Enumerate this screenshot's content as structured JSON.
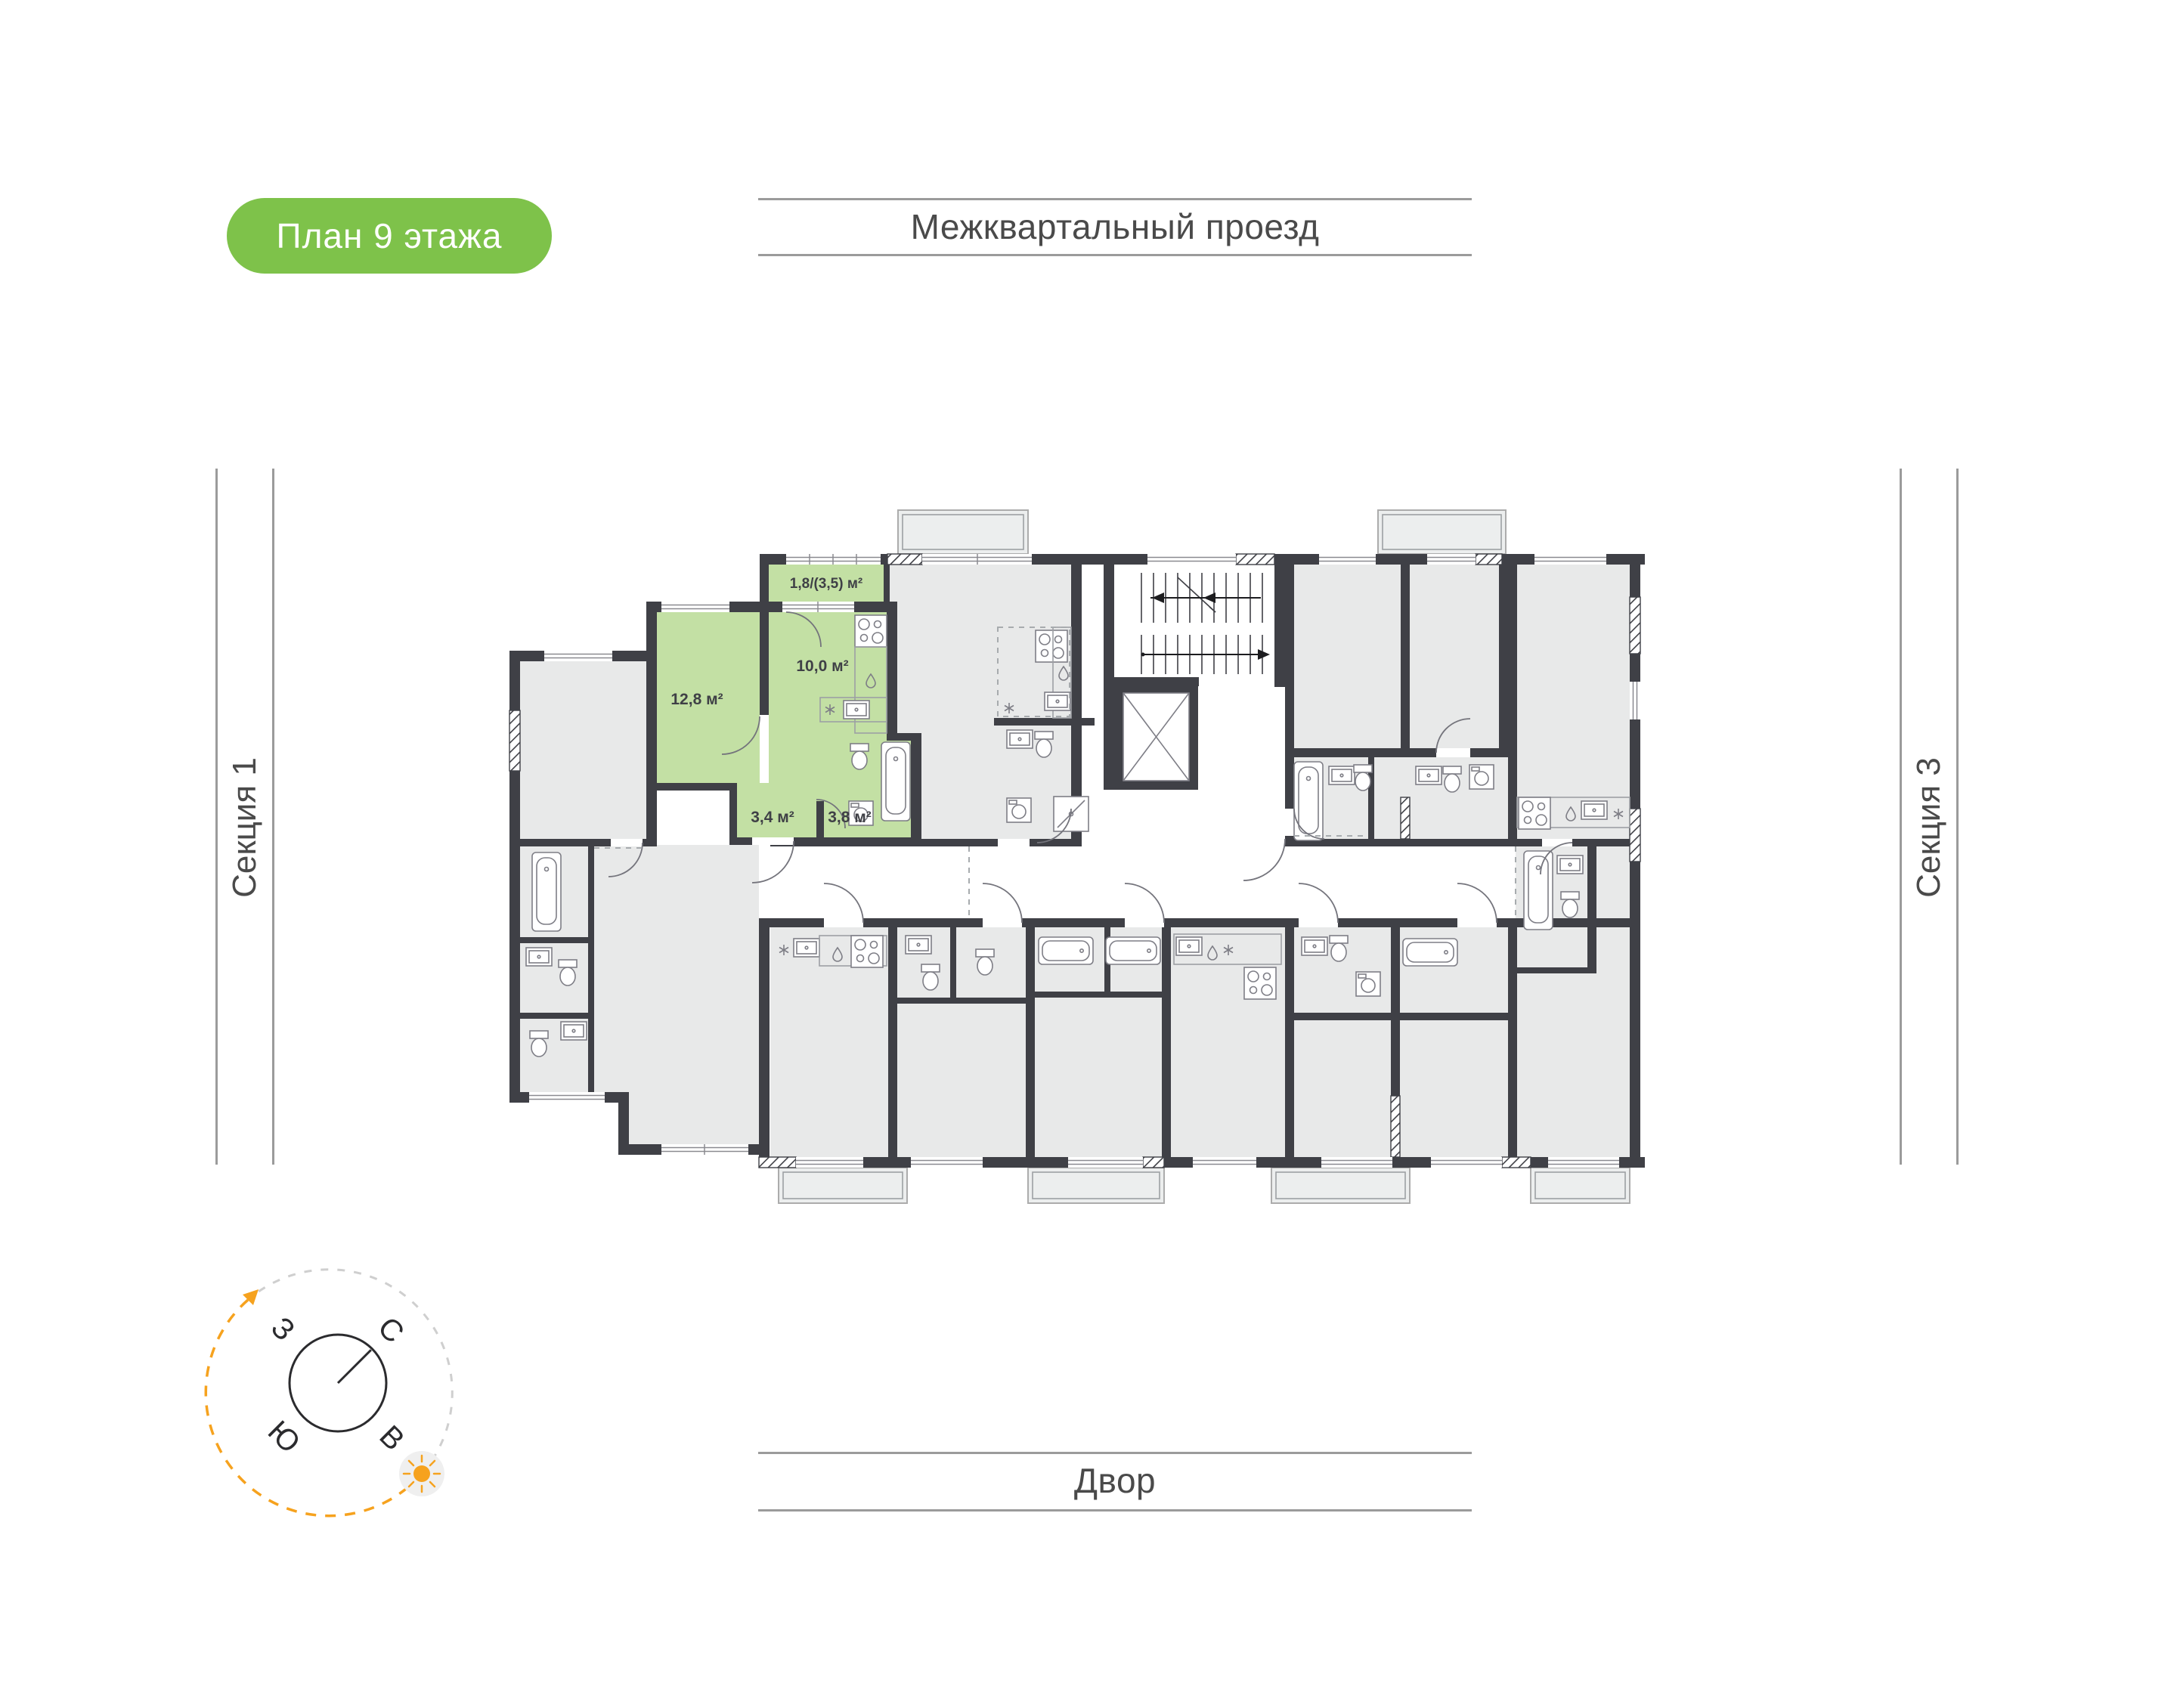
{
  "page": {
    "bg_color": "#FFFFFF"
  },
  "badge": {
    "label": "План 9 этажа",
    "bg_color": "#7EC24A",
    "text_color": "#FFFFFF"
  },
  "streets": {
    "top_label": "Межквартальный проезд",
    "bottom_label": "Двор",
    "line_color": "#9B9B9B",
    "text_color": "#4A4A4A"
  },
  "sections": {
    "left_label": "Секция 1",
    "right_label": "Секция 3",
    "line_color": "#9B9B9B",
    "text_color": "#4A4A4A"
  },
  "plan": {
    "title": "План 9 этажа",
    "colors": {
      "wall": "#3F4046",
      "room_fill": "#E8E9E9",
      "balcony_fill": "#ECEEEE",
      "highlight_fill": "#C3E0A4",
      "fixture_line": "#7E7E86",
      "label_text": "#3F4046"
    },
    "apartment": {
      "highlighted": true,
      "rooms": [
        {
          "name": "balcony",
          "area": "1,8/(3,5) м²"
        },
        {
          "name": "living-room",
          "area": "12,8 м²"
        },
        {
          "name": "kitchen",
          "area": "10,0 м²"
        },
        {
          "name": "hallway",
          "area": "3,4 м²"
        },
        {
          "name": "bathroom",
          "area": "3,8 м²"
        }
      ]
    }
  },
  "compass": {
    "north": "С",
    "east": "В",
    "south": "Ю",
    "west": "З",
    "accent_color": "#F6A21E",
    "arc_color": "#CFCFCF"
  }
}
